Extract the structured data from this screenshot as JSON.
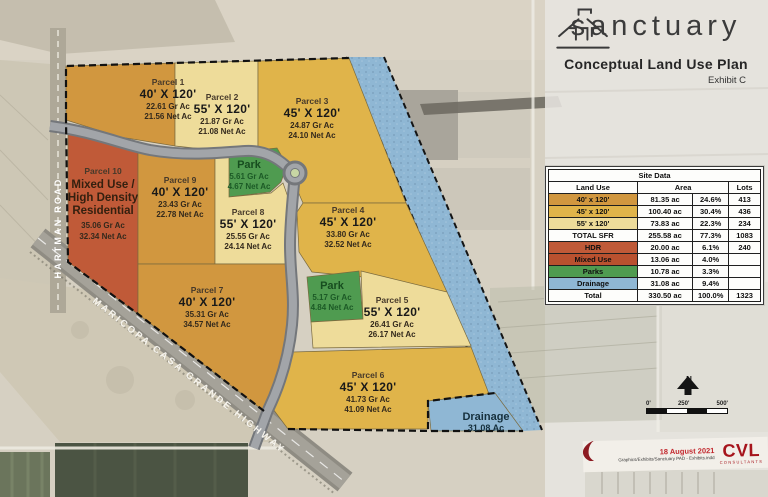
{
  "logo": {
    "name": "sanctuary",
    "plan_title": "Conceptual Land Use Plan",
    "exhibit": "Exhibit C"
  },
  "colors": {
    "sfr40": "#D1973F",
    "sfr45": "#E0B44A",
    "sfr55": "#EEDC9A",
    "hdr": "#C05A38",
    "mixed_use": "#B9512F",
    "park": "#4F9B50",
    "drainage": "#8FB7D4"
  },
  "map": {
    "road_labels": {
      "hartman": "HARTMAN ROAD",
      "highway": "MARICOPA CASA GRANDE HIGHWAY"
    },
    "parcels": [
      {
        "name": "Parcel 1",
        "dim": "40' X 120'",
        "gross": "22.61 Gr Ac",
        "net": "21.56 Net Ac"
      },
      {
        "name": "Parcel 2",
        "dim": "55' X 120'",
        "gross": "21.87 Gr Ac",
        "net": "21.08 Net Ac"
      },
      {
        "name": "Parcel 3",
        "dim": "45' X 120'",
        "gross": "24.87 Gr Ac",
        "net": "24.10 Net Ac"
      },
      {
        "name": "Parcel 4",
        "dim": "45' X 120'",
        "gross": "33.80 Gr Ac",
        "net": "32.52 Net Ac"
      },
      {
        "name": "Parcel 5",
        "dim": "55' X 120'",
        "gross": "26.41 Gr Ac",
        "net": "26.17 Net Ac"
      },
      {
        "name": "Parcel 6",
        "dim": "45' X 120'",
        "gross": "41.73 Gr Ac",
        "net": "41.09 Net Ac"
      },
      {
        "name": "Parcel 7",
        "dim": "40' X 120'",
        "gross": "35.31 Gr Ac",
        "net": "34.57 Net Ac"
      },
      {
        "name": "Parcel 8",
        "dim": "55' X 120'",
        "gross": "25.55 Gr Ac",
        "net": "24.14 Net Ac"
      },
      {
        "name": "Parcel 9",
        "dim": "40' X 120'",
        "gross": "23.43 Gr Ac",
        "net": "22.78 Net Ac"
      },
      {
        "name": "Parcel 10",
        "use_line1": "Mixed Use /",
        "use_line2": "High Density",
        "use_line3": "Residential",
        "gross": "35.06 Gr Ac",
        "net": "32.34 Net Ac"
      }
    ],
    "parks": [
      {
        "name": "Park",
        "gross": "5.61 Gr Ac",
        "net": "4.67 Net Ac"
      },
      {
        "name": "Park",
        "gross": "5.17 Gr Ac",
        "net": "4.84 Net Ac"
      }
    ],
    "drainage": {
      "name": "Drainage",
      "area": "31.08 Ac"
    }
  },
  "site_table": {
    "title": "Site Data",
    "headers": {
      "land_use": "Land Use",
      "area": "Area",
      "lots": "Lots"
    },
    "rows": [
      {
        "land_use": "40' x 120'",
        "area": "81.35 ac",
        "pct": "24.6%",
        "lots": "413"
      },
      {
        "land_use": "45' x 120'",
        "area": "100.40 ac",
        "pct": "30.4%",
        "lots": "436"
      },
      {
        "land_use": "55' x 120'",
        "area": "73.83 ac",
        "pct": "22.3%",
        "lots": "234"
      },
      {
        "land_use": "TOTAL SFR",
        "area": "255.58 ac",
        "pct": "77.3%",
        "lots": "1083"
      },
      {
        "land_use": "HDR",
        "area": "20.00 ac",
        "pct": "6.1%",
        "lots": "240"
      },
      {
        "land_use": "Mixed Use",
        "area": "13.06 ac",
        "pct": "4.0%",
        "lots": ""
      },
      {
        "land_use": "Parks",
        "area": "10.78 ac",
        "pct": "3.3%",
        "lots": ""
      },
      {
        "land_use": "Drainage",
        "area": "31.08 ac",
        "pct": "9.4%",
        "lots": ""
      },
      {
        "land_use": "Total",
        "area": "330.50 ac",
        "pct": "100.0%",
        "lots": "1323"
      }
    ]
  },
  "annotations": {
    "north_label": "N",
    "scale": {
      "tick0": "0'",
      "tick250": "250'",
      "tick500": "500'"
    },
    "date": "18 August 2021",
    "file_ref": "Graphics/Exhibits/Sanctuary PAD - Exhibits.indd",
    "firm": "CVL",
    "firm_tagline": "CONSULTANTS"
  }
}
